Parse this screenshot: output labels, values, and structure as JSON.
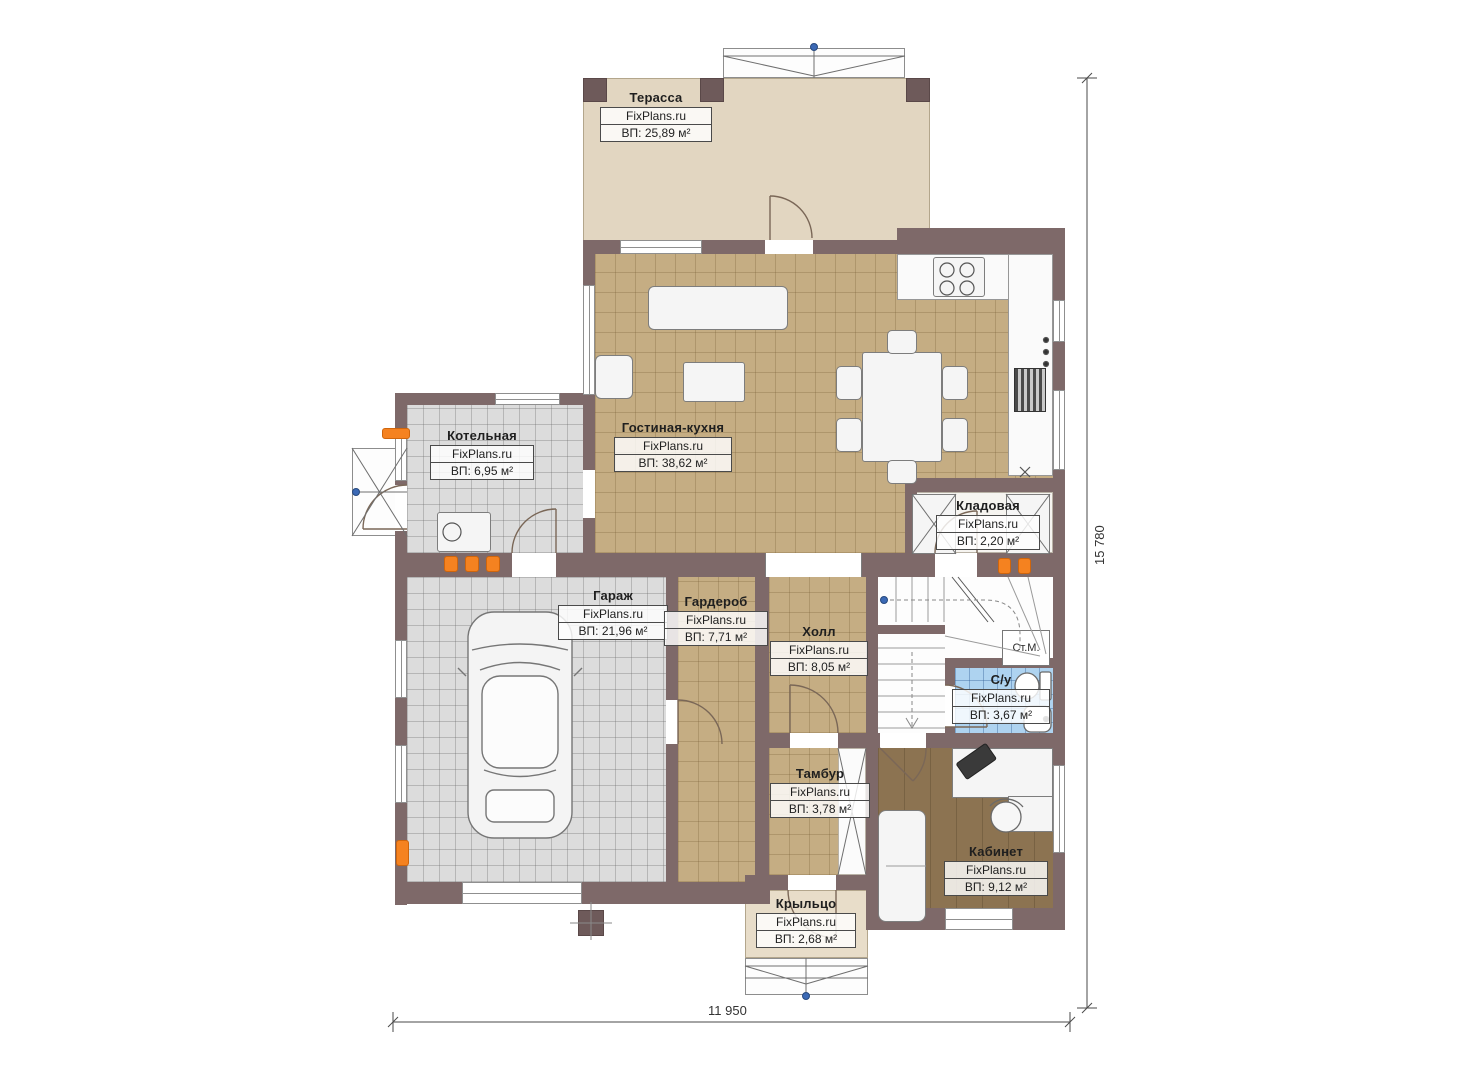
{
  "brand": "FixPlans.ru",
  "rooms": [
    {
      "id": "terrace",
      "name": "Терасса",
      "brand": "FixPlans.ru",
      "area": "ВП: 25,89 м²"
    },
    {
      "id": "living",
      "name": "Гостиная-кухня",
      "brand": "FixPlans.ru",
      "area": "ВП: 38,62 м²"
    },
    {
      "id": "boiler",
      "name": "Котельная",
      "brand": "FixPlans.ru",
      "area": "ВП: 6,95 м²"
    },
    {
      "id": "storage",
      "name": "Кладовая",
      "brand": "FixPlans.ru",
      "area": "ВП: 2,20 м²"
    },
    {
      "id": "garage",
      "name": "Гараж",
      "brand": "FixPlans.ru",
      "area": "ВП: 21,96 м²"
    },
    {
      "id": "wardrobe",
      "name": "Гардероб",
      "brand": "FixPlans.ru",
      "area": "ВП: 7,71 м²"
    },
    {
      "id": "hall",
      "name": "Холл",
      "brand": "FixPlans.ru",
      "area": "ВП: 8,05 м²"
    },
    {
      "id": "wc",
      "name": "С/у",
      "brand": "FixPlans.ru",
      "area": "ВП: 3,67 м²"
    },
    {
      "id": "tambur",
      "name": "Тамбур",
      "brand": "FixPlans.ru",
      "area": "ВП: 3,78 м²"
    },
    {
      "id": "office",
      "name": "Кабинет",
      "brand": "FixPlans.ru",
      "area": "ВП: 9,12 м²"
    },
    {
      "id": "porch",
      "name": "Крыльцо",
      "brand": "FixPlans.ru",
      "area": "ВП: 2,68 м²"
    }
  ],
  "annotations": {
    "washing_machine": "Ст.М."
  },
  "dimensions": {
    "width": "11 950",
    "height": "15 780"
  },
  "colors": {
    "wall": "#7e6969",
    "terrace_floor": "#e2d6c1",
    "tile_tan": "#c5ad83",
    "tile_grey": "#dcdcdc",
    "tile_blue": "#aed3f0",
    "wood_floor": "#8c7351",
    "porch_floor": "#e8ddc9",
    "radiator_orange": "#f58220",
    "marker_blue": "#3b69b5"
  }
}
